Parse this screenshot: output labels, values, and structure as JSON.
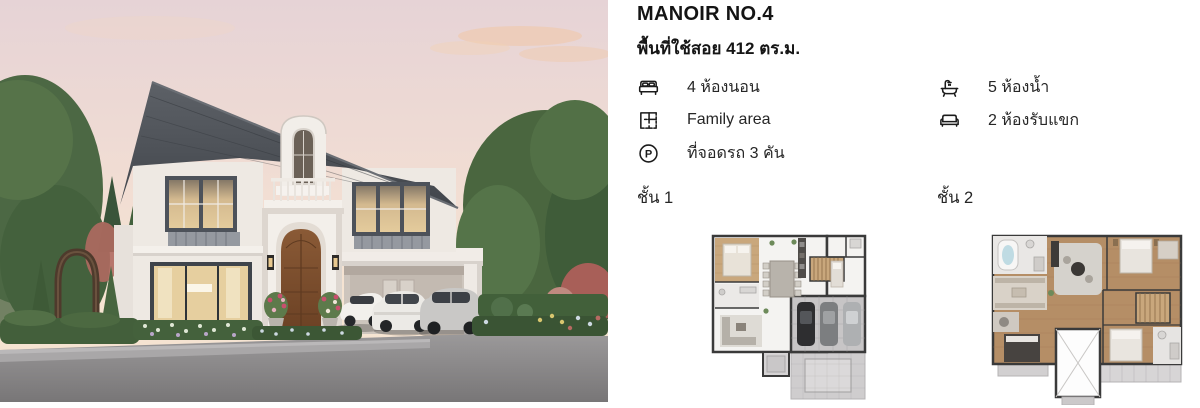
{
  "listing": {
    "title": "MANOIR NO.4",
    "area": "พื้นที่ใช้สอย 412 ตร.ม.",
    "features": [
      {
        "name": "bedrooms",
        "icon": "bed-icon",
        "label": "4 ห้องนอน"
      },
      {
        "name": "family-area",
        "icon": "floorplan-icon",
        "label": "Family area"
      },
      {
        "name": "parking",
        "icon": "parking-icon",
        "label": "ที่จอดรถ 3 คัน"
      },
      {
        "name": "bathrooms",
        "icon": "bathtub-icon",
        "label": "5 ห้องน้ำ"
      },
      {
        "name": "living-rooms",
        "icon": "sofa-icon",
        "label": "2 ห้องรับแขก"
      }
    ],
    "parking_letter": "P",
    "floors": [
      {
        "label": "ชั้น 1"
      },
      {
        "label": "ชั้น 2"
      }
    ]
  },
  "colors": {
    "text": "#1c1c1c",
    "roof": "#474c52",
    "facade": "#efeae4",
    "door_wood": "#7c4f2e",
    "plan_wood": "#c9a77c",
    "driveway": "#8b898a",
    "sky_top": "#e6d3d6",
    "sky_bottom": "#f6e5d2"
  }
}
